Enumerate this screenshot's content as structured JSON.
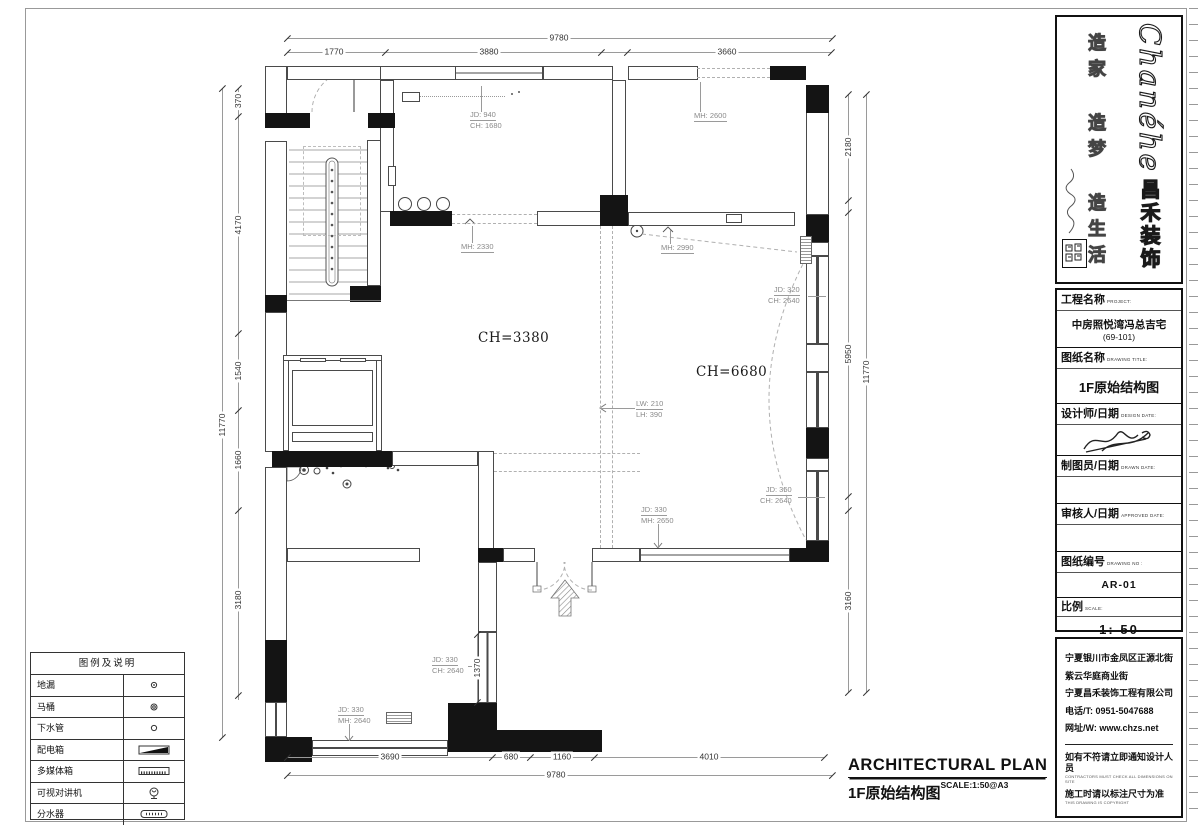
{
  "plan": {
    "rooms": {
      "living_ch": "CH=3380",
      "hall_ch": "CH=6680",
      "elevator": "ELEVATOR"
    },
    "annotations": {
      "jd940": {
        "l1": "JD: 940",
        "l2": "CH: 1680"
      },
      "mh2330": {
        "l1": "MH: 2330"
      },
      "mh2600": {
        "l1": "MH: 2600"
      },
      "mh2990": {
        "l1": "MH: 2990"
      },
      "jd320": {
        "l1": "JD: 320",
        "l2": "CH: 2640"
      },
      "lw210": {
        "l1": "LW: 210",
        "l2": "LH: 390"
      },
      "jd350": {
        "l1": "JD: 350",
        "l2": "CH: 2640"
      },
      "jd330_mh2650": {
        "l1": "JD: 330",
        "l2": "MH: 2650"
      },
      "jd330_ch2640": {
        "l1": "JD: 330",
        "l2": "CH: 2640"
      },
      "jd330_mh2640": {
        "l1": "JD: 330",
        "l2": "MH: 2640"
      }
    },
    "dims": {
      "top": {
        "overall": "9780",
        "segs": [
          "1770",
          "3880",
          "3660"
        ]
      },
      "bottom": {
        "overall": "9780",
        "segs": [
          "3690",
          "680",
          "1160",
          "4010"
        ]
      },
      "left": {
        "overall": "11770",
        "segs": [
          "370",
          "4170",
          "1540",
          "1660",
          "3180"
        ]
      },
      "right": {
        "overall": "11770",
        "segs": [
          "2180",
          "5950",
          "3160"
        ]
      },
      "window_w": "1370"
    }
  },
  "legend": {
    "title": "图例及说明",
    "rows": [
      {
        "label": "地漏"
      },
      {
        "label": "马桶"
      },
      {
        "label": "下水管"
      },
      {
        "label": "配电箱"
      },
      {
        "label": "多媒体箱"
      },
      {
        "label": "可视对讲机"
      },
      {
        "label": "分水器"
      }
    ]
  },
  "titleblock": {
    "brand": {
      "logo_en": "Chanéhe",
      "logo_cn": "昌禾装饰",
      "slogan": "造家 造梦 造生活"
    },
    "fields": [
      {
        "label": "工程名称",
        "sub": "PROJECT:",
        "value": "中房照悦湾冯总吉宅",
        "value2": "(69-101)"
      },
      {
        "label": "图纸名称",
        "sub": "DRAWING TITLE:",
        "value": "1F原始结构图"
      },
      {
        "label": "设计师/日期",
        "sub": "DESIGN DATE:"
      },
      {
        "label": "制图员/日期",
        "sub": "DRAWN DATE:"
      },
      {
        "label": "审核人/日期",
        "sub": "APPROVED DATE:"
      },
      {
        "label": "图纸编号",
        "sub": "DRAWING NO :",
        "value": "AR-01"
      },
      {
        "label": "比例",
        "sub": "SCALE:",
        "value": "1: 50"
      }
    ],
    "company": {
      "address1": "宁夏银川市金凤区正源北街",
      "address2": "紫云华庭商业街",
      "name": "宁夏昌禾装饰工程有限公司",
      "phone": "电话/T: 0951-5047688",
      "web": "网址/W: www.chzs.net",
      "note1": "如有不符请立即通知设计人员",
      "note1_en": "CONTRACTORS MUST CHECK ALL DIMENSIONS ON SITE",
      "note2": "施工时请以标注尺寸为准",
      "note2_en": "THIS DRAWING IS COPYRIGHT"
    }
  },
  "footer": {
    "title_en": "ARCHITECTURAL PLAN",
    "title_cn": "1F原始结构图",
    "scale_note": "SCALE:1:50@A3"
  }
}
